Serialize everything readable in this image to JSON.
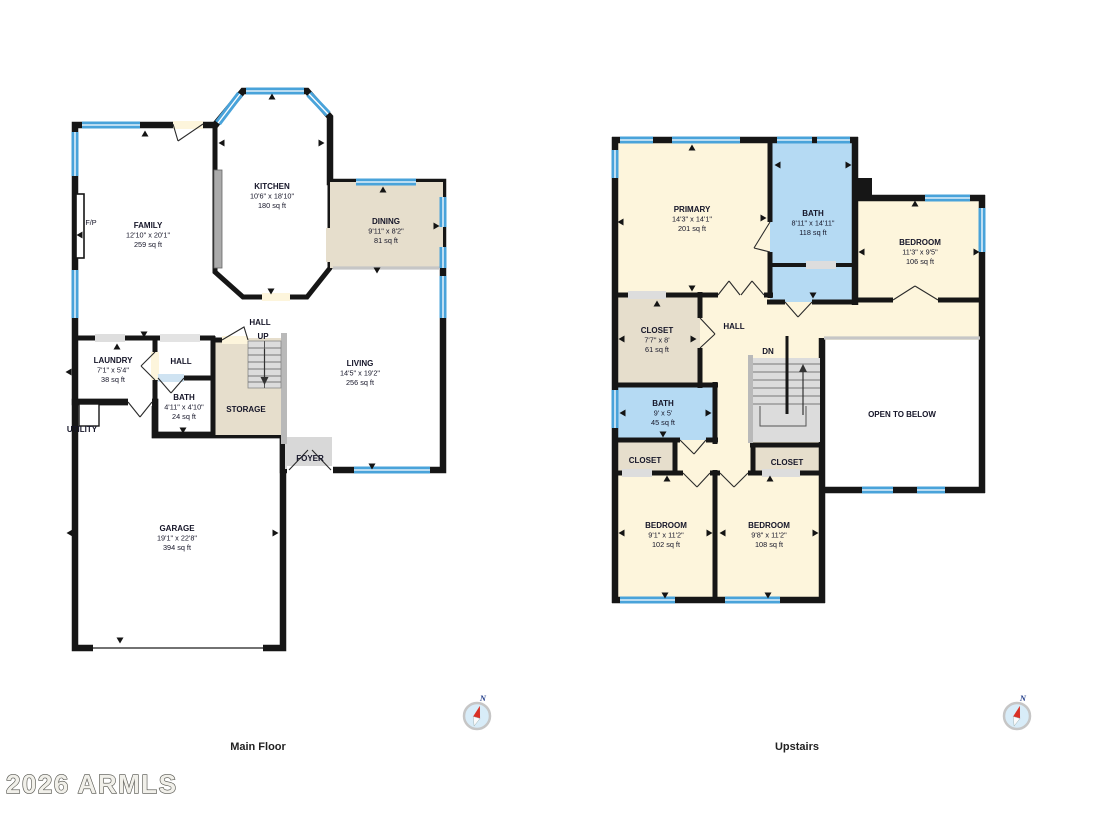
{
  "watermark": "2026 ARMLS",
  "captions": {
    "main": "Main Floor",
    "up": "Upstairs"
  },
  "compass": {
    "label": "N"
  },
  "colors": {
    "wall": "#161616",
    "window_blue": "#49a3da",
    "room_cream": "#fdf5dc",
    "room_tan": "#e6decc",
    "room_green": "#e3efe8",
    "room_blue": "#b5daf3",
    "stairs_gray": "#dcdcdc",
    "foyer_gray": "#d8d8d8"
  },
  "mf": {
    "family": {
      "name": "FAMILY",
      "dims": "12'10\" x 20'1\"",
      "area": "259 sq ft"
    },
    "kitchen": {
      "name": "KITCHEN",
      "dims": "10'6\" x 18'10\"",
      "area": "180 sq ft"
    },
    "dining": {
      "name": "DINING",
      "dims": "9'11\" x 8'2\"",
      "area": "81 sq ft"
    },
    "living": {
      "name": "LIVING",
      "dims": "14'5\" x 19'2\"",
      "area": "256 sq ft"
    },
    "laundry": {
      "name": "LAUNDRY",
      "dims": "7'1\" x 5'4\"",
      "area": "38 sq ft"
    },
    "bath": {
      "name": "BATH",
      "dims": "4'11\" x 4'10\"",
      "area": "24 sq ft"
    },
    "garage": {
      "name": "GARAGE",
      "dims": "19'1\" x 22'8\"",
      "area": "394 sq ft"
    },
    "hall": {
      "name": "HALL"
    },
    "hall2": {
      "name": "HALL"
    },
    "storage": {
      "name": "STORAGE"
    },
    "utility": {
      "name": "UTILITY"
    },
    "foyer": {
      "name": "FOYER"
    },
    "fp": {
      "name": "F/P"
    },
    "up": {
      "name": "UP"
    }
  },
  "uf": {
    "primary": {
      "name": "PRIMARY",
      "dims": "14'3\" x 14'1\"",
      "area": "201 sq ft"
    },
    "bath": {
      "name": "BATH",
      "dims": "8'11\" x 14'11\"",
      "area": "118 sq ft"
    },
    "bedroom1": {
      "name": "BEDROOM",
      "dims": "11'3\" x 9'5\"",
      "area": "106 sq ft"
    },
    "closet1": {
      "name": "CLOSET",
      "dims": "7'7\" x 8'",
      "area": "61 sq ft"
    },
    "bath2": {
      "name": "BATH",
      "dims": "9' x 5'",
      "area": "45 sq ft"
    },
    "bedroom2": {
      "name": "BEDROOM",
      "dims": "9'1\" x 11'2\"",
      "area": "102 sq ft"
    },
    "bedroom3": {
      "name": "BEDROOM",
      "dims": "9'8\" x 11'2\"",
      "area": "108 sq ft"
    },
    "closet2": {
      "name": "CLOSET"
    },
    "closet3": {
      "name": "CLOSET"
    },
    "hall": {
      "name": "HALL"
    },
    "dn": {
      "name": "DN"
    },
    "open": {
      "name": "OPEN TO BELOW"
    }
  }
}
